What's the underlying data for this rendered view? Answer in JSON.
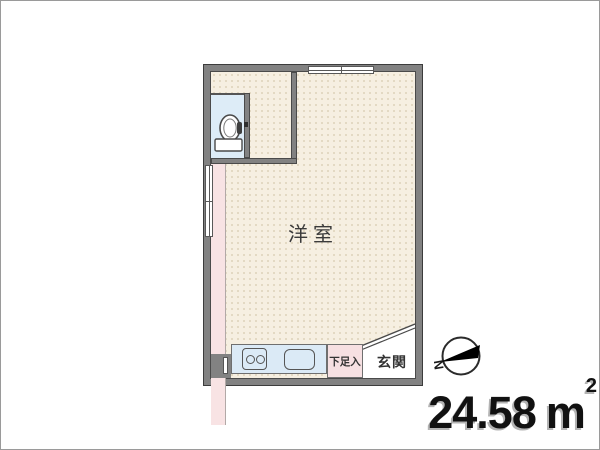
{
  "floorplan": {
    "main_room_label": "洋室",
    "shoe_storage_label": "下足入",
    "entrance_label": "玄関",
    "compass_letter": "N",
    "area_value": "24.58",
    "area_unit": "m",
    "area_superscript": "2"
  },
  "colors": {
    "wall_gray": "#828282",
    "wall_outline": "#3c3c3c",
    "floor_cream": "#f6efe1",
    "toilet_floor_blue": "#ddecf7",
    "kitchen_counter_blue": "#dbeaf6",
    "accent_pink": "#f8e3e4",
    "entrance_white": "#ffffff",
    "area_text_black": "#111111"
  }
}
